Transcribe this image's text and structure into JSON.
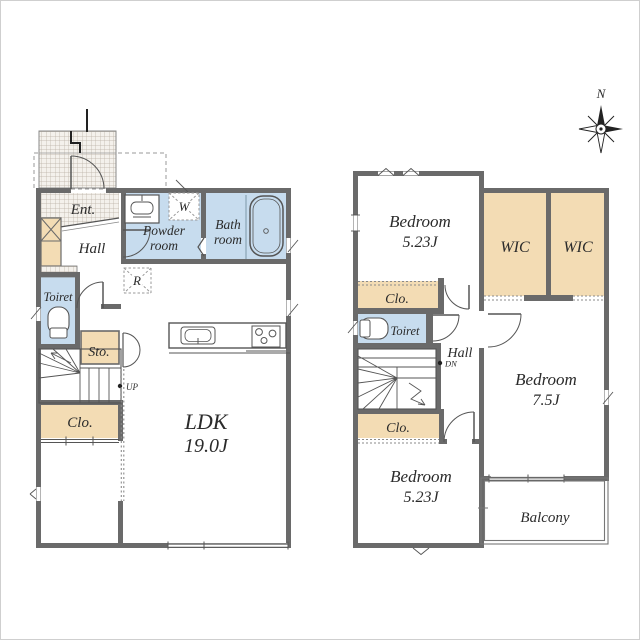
{
  "compass": {
    "north": "N"
  },
  "floor1": {
    "entrance": "Ent.",
    "hall": "Hall",
    "powder_room": [
      "Powder",
      "room"
    ],
    "washer_symbol": "W",
    "bath_room": [
      "Bath",
      "room"
    ],
    "toilet": "Toiret",
    "fridge_symbol": "R",
    "storage": "Sto.",
    "closet": "Clo.",
    "stairs_direction": "UP",
    "ldk": [
      "LDK",
      "19.0J"
    ]
  },
  "floor2": {
    "bedroom_top": [
      "Bedroom",
      "5.23J"
    ],
    "wic_left": "WIC",
    "wic_right": "WIC",
    "closet_upper": "Clo.",
    "toilet": "Toiret",
    "hall": "Hall",
    "stairs_direction": "DN",
    "bedroom_right": [
      "Bedroom",
      "7.5J"
    ],
    "closet_lower": "Clo.",
    "bedroom_bottom": [
      "Bedroom",
      "5.23J"
    ],
    "balcony": "Balcony"
  },
  "colors": {
    "wall": "#6a6a6a",
    "wet_area": "#c7dcee",
    "storage_area": "#f3dcb4",
    "text": "#2b2b2b"
  }
}
